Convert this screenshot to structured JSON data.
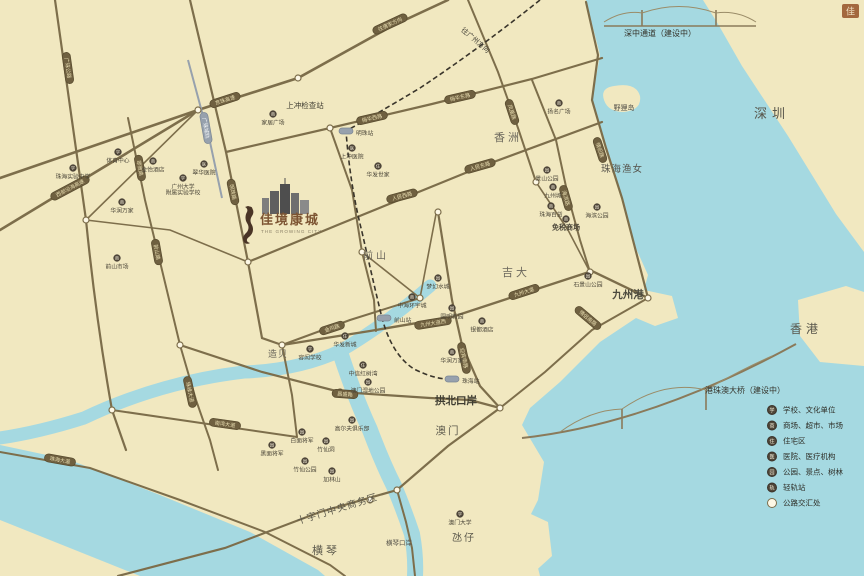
{
  "brand": {
    "name": "佳境康城",
    "tagline": "THE GROWING CITY",
    "stamp": "佳"
  },
  "colors": {
    "paper": "#f1e8c0",
    "water": "#a5d9e1",
    "road": "#7d6e4b",
    "pill_fill": "#6f6040",
    "pill_text": "#eadfb2",
    "poi_fill": "#4f4639",
    "poi_glyph": "#f2ecd8",
    "rail_dash": "#3a352b",
    "rail_pill": "#97a1ad",
    "label_text": "#4a4538",
    "brand_text": "#7d5533"
  },
  "icons": {
    "school": "学",
    "mall": "商",
    "resi": "住",
    "hosp": "医",
    "park": "园",
    "railst": "轨"
  },
  "legend": {
    "items": [
      {
        "type": "school",
        "label": "学校、文化单位"
      },
      {
        "type": "mall",
        "label": "商场、超市、市场"
      },
      {
        "type": "resi",
        "label": "住宅区"
      },
      {
        "type": "hosp",
        "label": "医院、医疗机构"
      },
      {
        "type": "park",
        "label": "公园、景点、树林"
      },
      {
        "type": "railst",
        "label": "轻轨站"
      },
      {
        "type": "junction",
        "label": "公路交汇处"
      }
    ]
  },
  "map": {
    "area_labels": [
      {
        "label": "深圳",
        "x": 772,
        "y": 118,
        "size": 13,
        "ls": 5,
        "color": "#57554a"
      },
      {
        "label": "香港",
        "x": 806,
        "y": 333,
        "size": 12,
        "ls": 4,
        "color": "#57554a"
      },
      {
        "label": "澳门",
        "x": 448,
        "y": 434,
        "size": 10.5,
        "ls": 2,
        "color": "#5c594c"
      },
      {
        "label": "氹仔",
        "x": 464,
        "y": 541,
        "size": 10,
        "ls": 2,
        "color": "#5c594c"
      },
      {
        "label": "横琴",
        "x": 326,
        "y": 554,
        "size": 11,
        "ls": 3,
        "color": "#5c594c"
      },
      {
        "label": "香洲",
        "x": 508,
        "y": 141,
        "size": 11,
        "ls": 3,
        "color": "#6b675c"
      },
      {
        "label": "吉大",
        "x": 516,
        "y": 276,
        "size": 11,
        "ls": 3,
        "color": "#6b675c"
      },
      {
        "label": "前山",
        "x": 376,
        "y": 259,
        "size": 10,
        "ls": 3,
        "color": "#6b675c"
      },
      {
        "label": "造贝",
        "x": 278,
        "y": 357,
        "size": 9,
        "ls": 1,
        "color": "#6b675c"
      },
      {
        "label": "九州港",
        "x": 628,
        "y": 298,
        "size": 10.5,
        "bold": true,
        "color": "#4d4b3f"
      },
      {
        "label": "野狸岛",
        "x": 624,
        "y": 110,
        "size": 7,
        "color": "#55524a"
      },
      {
        "label": "珠海渔女",
        "x": 622,
        "y": 172,
        "size": 9.5,
        "ls": 1,
        "color": "#55524a"
      },
      {
        "label": "拱北口岸",
        "x": 456,
        "y": 404,
        "size": 10.5,
        "bold": true,
        "color": "#3e3c31"
      },
      {
        "label": "横琴口岸",
        "x": 399,
        "y": 545,
        "size": 6.5,
        "color": "#55524a"
      },
      {
        "label": "上冲检查站",
        "x": 305,
        "y": 108,
        "size": 7.5,
        "color": "#3e3c31"
      },
      {
        "label": "十字门中央商务区",
        "x": 338,
        "y": 512,
        "size": 9.5,
        "rot": -17,
        "ls": 1,
        "color": "#5a574a"
      },
      {
        "label": "深中通道（建设中）",
        "x": 660,
        "y": 36,
        "size": 8,
        "color": "#35332a"
      },
      {
        "label": "港珠澳大桥（建设中）",
        "x": 745,
        "y": 393,
        "size": 8,
        "color": "#35332a"
      },
      {
        "label": "往广州方向",
        "x": 474,
        "y": 42,
        "size": 7,
        "rot": 40,
        "color": "#4a473c"
      }
    ],
    "road_labels": [
      {
        "label": "西部沿海高速",
        "x": 70,
        "y": 188,
        "rot": -28
      },
      {
        "label": "京珠高速",
        "x": 225,
        "y": 100,
        "rot": -18
      },
      {
        "label": "往唐家方向",
        "x": 390,
        "y": 24,
        "rot": -25
      },
      {
        "label": "广珠公路",
        "x": 68,
        "y": 68,
        "rot": 82
      },
      {
        "label": "明珠路",
        "x": 233,
        "y": 192,
        "rot": 78
      },
      {
        "label": "翠微路",
        "x": 140,
        "y": 168,
        "rot": 80
      },
      {
        "label": "前山路",
        "x": 157,
        "y": 252,
        "rot": 80
      },
      {
        "label": "珠峰大道",
        "x": 190,
        "y": 392,
        "rot": 78
      },
      {
        "label": "梅华西路",
        "x": 372,
        "y": 118,
        "rot": -13
      },
      {
        "label": "梅华东路",
        "x": 460,
        "y": 97,
        "rot": -13
      },
      {
        "label": "人民西路",
        "x": 402,
        "y": 196,
        "rot": -15
      },
      {
        "label": "人民东路",
        "x": 480,
        "y": 166,
        "rot": -16
      },
      {
        "label": "凤凰路",
        "x": 512,
        "y": 112,
        "rot": 72
      },
      {
        "label": "情侣路",
        "x": 600,
        "y": 150,
        "rot": 72
      },
      {
        "label": "海滨路",
        "x": 566,
        "y": 198,
        "rot": 74
      },
      {
        "label": "九州大道西",
        "x": 433,
        "y": 323,
        "rot": -9
      },
      {
        "label": "九州大道",
        "x": 524,
        "y": 292,
        "rot": -18
      },
      {
        "label": "迎宾南路",
        "x": 464,
        "y": 358,
        "rot": 78
      },
      {
        "label": "昌盛路",
        "x": 345,
        "y": 394,
        "rot": 4
      },
      {
        "label": "金鸡路",
        "x": 332,
        "y": 328,
        "rot": -18
      },
      {
        "label": "南湾大道",
        "x": 225,
        "y": 424,
        "rot": 8
      },
      {
        "label": "珠海大道",
        "x": 60,
        "y": 460,
        "rot": 10
      },
      {
        "label": "情侣南路",
        "x": 588,
        "y": 318,
        "rot": 40
      },
      {
        "label": "广珠城轨",
        "x": 206,
        "y": 128,
        "rot": 80,
        "type": "rail"
      }
    ],
    "stations": [
      {
        "label": "明珠站",
        "x": 346,
        "y": 131,
        "lx": 356,
        "ly": 133
      },
      {
        "label": "前山站",
        "x": 384,
        "y": 318,
        "lx": 394,
        "ly": 320
      },
      {
        "label": "珠海站",
        "x": 452,
        "y": 379,
        "lx": 462,
        "ly": 381
      }
    ],
    "pois": [
      {
        "type": "school",
        "label": "珠海实验中学",
        "x": 73,
        "y": 168
      },
      {
        "type": "school",
        "label": "广州大学",
        "label2": "附属实验学校",
        "x": 183,
        "y": 178
      },
      {
        "type": "school",
        "label": "体育中心",
        "x": 118,
        "y": 152
      },
      {
        "type": "school",
        "label": "容闳学校",
        "x": 310,
        "y": 349
      },
      {
        "type": "school",
        "label": "澳门大学",
        "x": 460,
        "y": 514
      },
      {
        "type": "mall",
        "label": "家居广场",
        "x": 273,
        "y": 114
      },
      {
        "type": "mall",
        "label": "金怡酒店",
        "x": 153,
        "y": 161
      },
      {
        "type": "mall",
        "label": "华润万家",
        "x": 122,
        "y": 202
      },
      {
        "type": "mall",
        "label": "前山市场",
        "x": 117,
        "y": 258
      },
      {
        "type": "mall",
        "label": "扬名广场",
        "x": 559,
        "y": 103
      },
      {
        "type": "mall",
        "label": "九州城",
        "x": 553,
        "y": 187
      },
      {
        "type": "mall",
        "label": "珠海百货",
        "x": 551,
        "y": 206
      },
      {
        "type": "mall",
        "label": "免税商场",
        "x": 566,
        "y": 219,
        "big": true
      },
      {
        "type": "mall",
        "label": "中海环宇城",
        "x": 412,
        "y": 297
      },
      {
        "type": "mall",
        "label": "银都酒店",
        "x": 482,
        "y": 321
      },
      {
        "type": "mall",
        "label": "华润万家",
        "x": 452,
        "y": 352
      },
      {
        "type": "resi",
        "label": "华发世家",
        "x": 378,
        "y": 166
      },
      {
        "type": "resi",
        "label": "华发新城",
        "x": 345,
        "y": 336
      },
      {
        "type": "resi",
        "label": "中信红树湾",
        "x": 363,
        "y": 365
      },
      {
        "type": "hosp",
        "label": "上冲医院",
        "x": 352,
        "y": 148
      },
      {
        "type": "hosp",
        "label": "翠华医院",
        "x": 204,
        "y": 164
      },
      {
        "type": "park",
        "label": "景山公园",
        "x": 547,
        "y": 170
      },
      {
        "type": "park",
        "label": "海滨公园",
        "x": 597,
        "y": 207
      },
      {
        "type": "park",
        "label": "石景山公园",
        "x": 588,
        "y": 276
      },
      {
        "type": "park",
        "label": "圆明新园",
        "x": 452,
        "y": 308
      },
      {
        "type": "park",
        "label": "梦幻水城",
        "x": 438,
        "y": 278
      },
      {
        "type": "park",
        "label": "澳门湿地公园",
        "x": 368,
        "y": 382
      },
      {
        "type": "park",
        "label": "黑面将军",
        "x": 272,
        "y": 445
      },
      {
        "type": "park",
        "label": "白面将军",
        "x": 302,
        "y": 432
      },
      {
        "type": "park",
        "label": "竹仙洞",
        "x": 326,
        "y": 441
      },
      {
        "type": "park",
        "label": "高尔夫俱乐部",
        "x": 352,
        "y": 420
      },
      {
        "type": "park",
        "label": "竹仙公园",
        "x": 305,
        "y": 461
      },
      {
        "type": "park",
        "label": "加林山",
        "x": 332,
        "y": 471
      }
    ],
    "junctions": [
      {
        "x": 198,
        "y": 110
      },
      {
        "x": 298,
        "y": 78
      },
      {
        "x": 330,
        "y": 128
      },
      {
        "x": 248,
        "y": 262
      },
      {
        "x": 282,
        "y": 345
      },
      {
        "x": 180,
        "y": 345
      },
      {
        "x": 362,
        "y": 252
      },
      {
        "x": 420,
        "y": 298
      },
      {
        "x": 500,
        "y": 408
      },
      {
        "x": 397,
        "y": 490
      },
      {
        "x": 648,
        "y": 298
      },
      {
        "x": 112,
        "y": 410
      },
      {
        "x": 86,
        "y": 220
      },
      {
        "x": 340,
        "y": 392
      },
      {
        "x": 536,
        "y": 182
      },
      {
        "x": 590,
        "y": 272
      },
      {
        "x": 438,
        "y": 212
      },
      {
        "x": 370,
        "y": 500
      }
    ]
  }
}
